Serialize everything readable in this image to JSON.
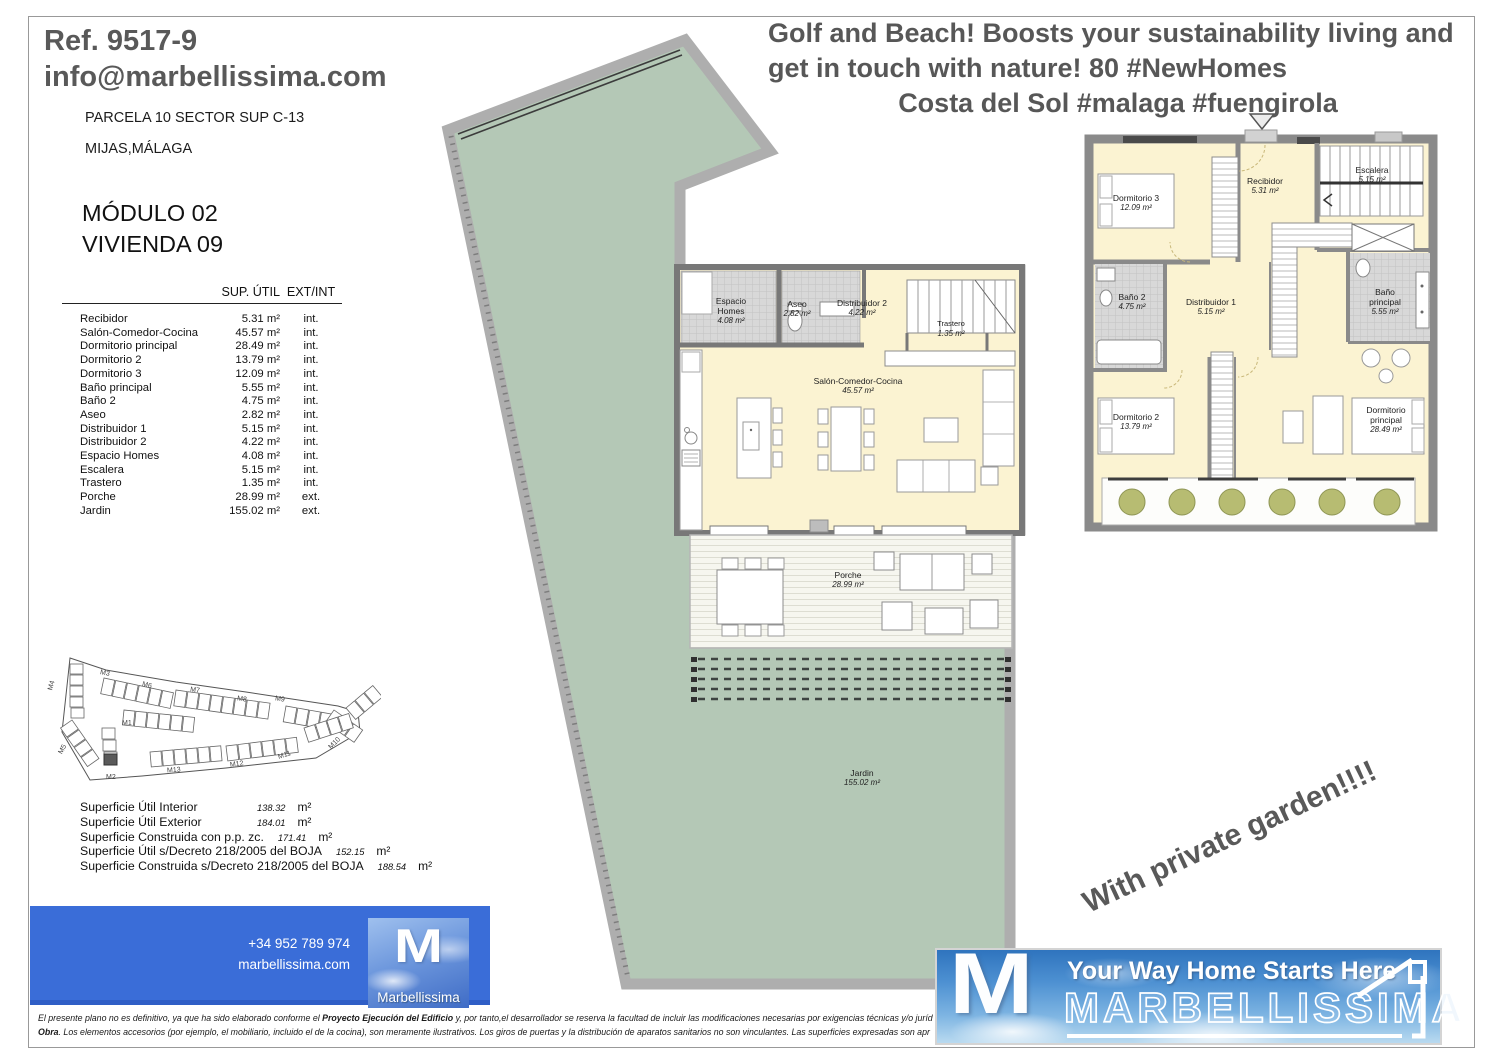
{
  "header": {
    "ref": "Ref. 9517-9",
    "email": "info@marbellissima.com",
    "parcela": "PARCELA 10 SECTOR SUP C-13",
    "city": "MIJAS,MÁLAGA",
    "modulo": "MÓDULO 02",
    "vivienda": "VIVIENDA 09"
  },
  "marketing": {
    "line1": "Golf and Beach! Boosts your sustainability living and",
    "line2": "get in touch with nature! 80 #NewHomes",
    "line3": "Costa del Sol #malaga #fuengirola"
  },
  "areas_table": {
    "col_sup": "SUP. ÚTIL",
    "col_extint": "EXT/INT",
    "rows": [
      {
        "name": "Recibidor",
        "area": "5.31 m²",
        "type": "int."
      },
      {
        "name": "Salón-Comedor-Cocina",
        "area": "45.57 m²",
        "type": "int."
      },
      {
        "name": "Dormitorio principal",
        "area": "28.49 m²",
        "type": "int."
      },
      {
        "name": "Dormitorio 2",
        "area": "13.79 m²",
        "type": "int."
      },
      {
        "name": "Dormitorio 3",
        "area": "12.09 m²",
        "type": "int."
      },
      {
        "name": "Baño principal",
        "area": "5.55 m²",
        "type": "int."
      },
      {
        "name": "Baño 2",
        "area": "4.75 m²",
        "type": "int."
      },
      {
        "name": "Aseo",
        "area": "2.82 m²",
        "type": "int."
      },
      {
        "name": "Distribuidor 1",
        "area": "5.15 m²",
        "type": "int."
      },
      {
        "name": "Distribuidor 2",
        "area": "4.22 m²",
        "type": "int."
      },
      {
        "name": "Espacio Homes",
        "area": "4.08 m²",
        "type": "int."
      },
      {
        "name": "Escalera",
        "area": "5.15 m²",
        "type": "int."
      },
      {
        "name": "Trastero",
        "area": "1.35 m²",
        "type": "int."
      },
      {
        "name": "Porche",
        "area": "28.99 m²",
        "type": "ext."
      },
      {
        "name": "Jardin",
        "area": "155.02 m²",
        "type": "ext."
      }
    ]
  },
  "totals": [
    {
      "label": "Superficie Útil Interior",
      "value": "138.32",
      "unit": "m²"
    },
    {
      "label": "Superficie Útil Exterior",
      "value": "184.01",
      "unit": "m²"
    },
    {
      "label": "Superficie Construida con p.p. zc.",
      "value": "171.41",
      "unit": "m²"
    },
    {
      "label": "Superficie Útil s/Decreto 218/2005 del BOJA",
      "value": "152.15",
      "unit": "m²"
    },
    {
      "label": "Superficie Construida s/Decreto 218/2005 del BOJA",
      "value": "188.54",
      "unit": "m²"
    }
  ],
  "site_map": {
    "modules": [
      "M1",
      "M2",
      "M3",
      "M4",
      "M5",
      "M6",
      "M7",
      "M8",
      "M9",
      "M10",
      "M11",
      "M12",
      "M13"
    ]
  },
  "contact": {
    "phone": "+34 952 789 974",
    "web": "marbellissima.com"
  },
  "footer_logo": {
    "m": "M",
    "name": "Marbellissima"
  },
  "banner": {
    "m": "M",
    "tagline": "Your Way Home Starts Here",
    "brand": "MARBELLISSIMA"
  },
  "promo": {
    "garden_note": "With private garden!!!!"
  },
  "disclaimer": {
    "l1_pre": "El presente plano no es definitivo, ya que ha sido elaborado conforme el ",
    "l1_bold": "Proyecto Ejecución del Edificio",
    "l1_post": " y, por tanto,el desarrollador se reserva la facultad de incluir las modificaciones necesarias por exigencias técnicas y/o juríd",
    "l2_bold": "Obra",
    "l2_post": ". Los elementos accesorios (por ejemplo, el mobiliario, incluido el de la cocina), son meramente ilustrativos. Los giros de puertas y la distribución de aparatos sanitarios no son vinculantes. Las superficies expresadas son apr"
  },
  "colors": {
    "garden_green": "#b4c8b6",
    "room_cream": "#fbf3d2",
    "wall_gray": "#8a8a8a",
    "footer_blue": "#3a6dd8",
    "headline_gray": "#575757"
  }
}
